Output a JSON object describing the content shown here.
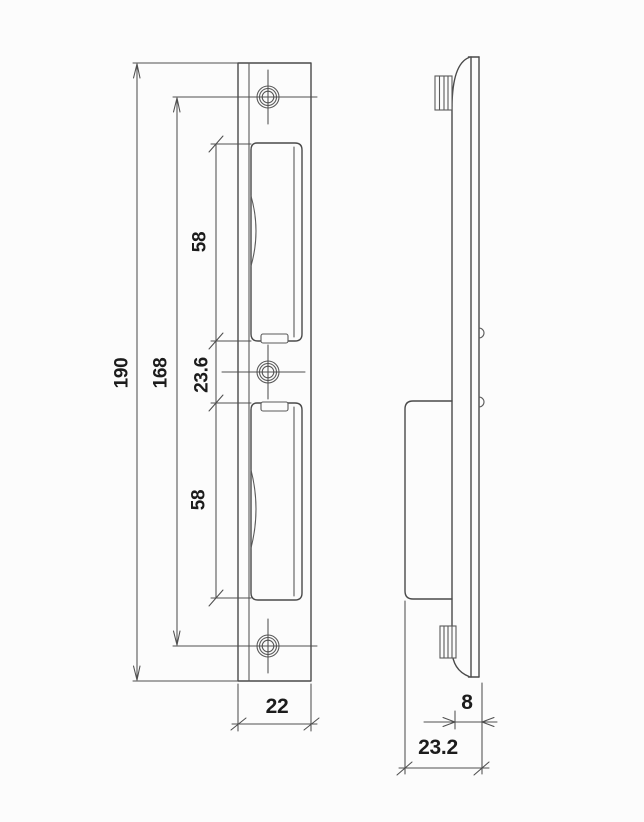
{
  "drawing": {
    "type": "technical-drawing",
    "subject": "door strike plate, front and side orthographic views",
    "front_view": {
      "dim_total_height": "190",
      "dim_screw_spacing": "168",
      "dim_upper_pocket": "58",
      "dim_center_gap": "23.6",
      "dim_lower_pocket": "58",
      "dim_width": "22"
    },
    "side_view": {
      "dim_face_depth": "8",
      "dim_total_depth": "23.2"
    },
    "style": {
      "line_color": "#4a4a4a",
      "text_color": "#1c1c1c",
      "background": "#fcfcfc"
    }
  }
}
